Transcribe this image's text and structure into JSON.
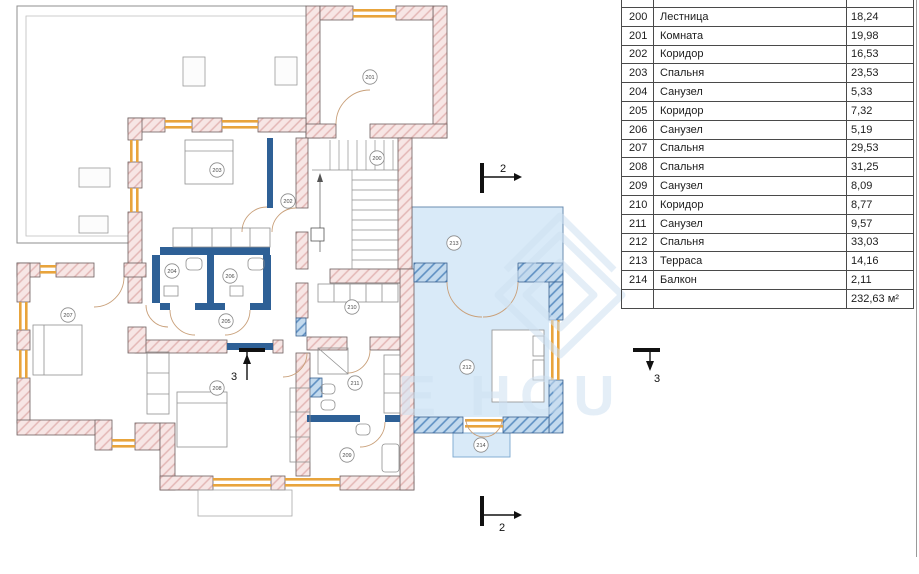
{
  "legend_table": {
    "rows": [
      {
        "number": "200",
        "name": "Лестница",
        "area": "18,24"
      },
      {
        "number": "201",
        "name": "Комната",
        "area": "19,98"
      },
      {
        "number": "202",
        "name": "Коридор",
        "area": "16,53"
      },
      {
        "number": "203",
        "name": "Спальня",
        "area": "23,53"
      },
      {
        "number": "204",
        "name": "Санузел",
        "area": "5,33"
      },
      {
        "number": "205",
        "name": "Коридор",
        "area": "7,32"
      },
      {
        "number": "206",
        "name": "Санузел",
        "area": "5,19"
      },
      {
        "number": "207",
        "name": "Спальня",
        "area": "29,53"
      },
      {
        "number": "208",
        "name": "Спальня",
        "area": "31,25"
      },
      {
        "number": "209",
        "name": "Санузел",
        "area": "8,09"
      },
      {
        "number": "210",
        "name": "Коридор",
        "area": "8,77"
      },
      {
        "number": "211",
        "name": "Санузел",
        "area": "9,57"
      },
      {
        "number": "212",
        "name": "Спальня",
        "area": "33,03"
      },
      {
        "number": "213",
        "name": "Терраса",
        "area": "14,16"
      },
      {
        "number": "214",
        "name": "Балкон",
        "area": "2,11"
      }
    ],
    "total": "232,63 м²"
  },
  "floor_plan": {
    "room_markers": [
      {
        "number": "200",
        "x": 377,
        "y": 158
      },
      {
        "number": "201",
        "x": 370,
        "y": 77
      },
      {
        "number": "202",
        "x": 288,
        "y": 201
      },
      {
        "number": "203",
        "x": 217,
        "y": 170
      },
      {
        "number": "204",
        "x": 172,
        "y": 271
      },
      {
        "number": "205",
        "x": 226,
        "y": 321
      },
      {
        "number": "206",
        "x": 230,
        "y": 276
      },
      {
        "number": "207",
        "x": 68,
        "y": 315
      },
      {
        "number": "208",
        "x": 217,
        "y": 388
      },
      {
        "number": "209",
        "x": 347,
        "y": 455
      },
      {
        "number": "210",
        "x": 352,
        "y": 307
      },
      {
        "number": "211",
        "x": 355,
        "y": 383
      },
      {
        "number": "212",
        "x": 467,
        "y": 367
      },
      {
        "number": "213",
        "x": 454,
        "y": 243
      },
      {
        "number": "214",
        "x": 481,
        "y": 445
      }
    ],
    "section_markers": [
      {
        "label": "2",
        "position": "top"
      },
      {
        "label": "2",
        "position": "bottom"
      },
      {
        "label": "3",
        "position": "in-plan"
      },
      {
        "label": "3",
        "position": "right"
      }
    ],
    "watermark_fragment": "E HOU"
  },
  "colors": {
    "wall_fill": "#f7e6e5",
    "wall_hatch": "#e3b7b5",
    "wall_stroke": "#6e5f5f",
    "blue_wall_fill": "#c3daee",
    "blue_wall_hatch": "#5d8fc2",
    "blue_wall_stroke": "#3a6190",
    "partition_blue": "#2e6096",
    "blue_floor": "#d9eaf8",
    "window_orange": "#e8a43c",
    "watermark_blue": "#cfe1f2"
  }
}
